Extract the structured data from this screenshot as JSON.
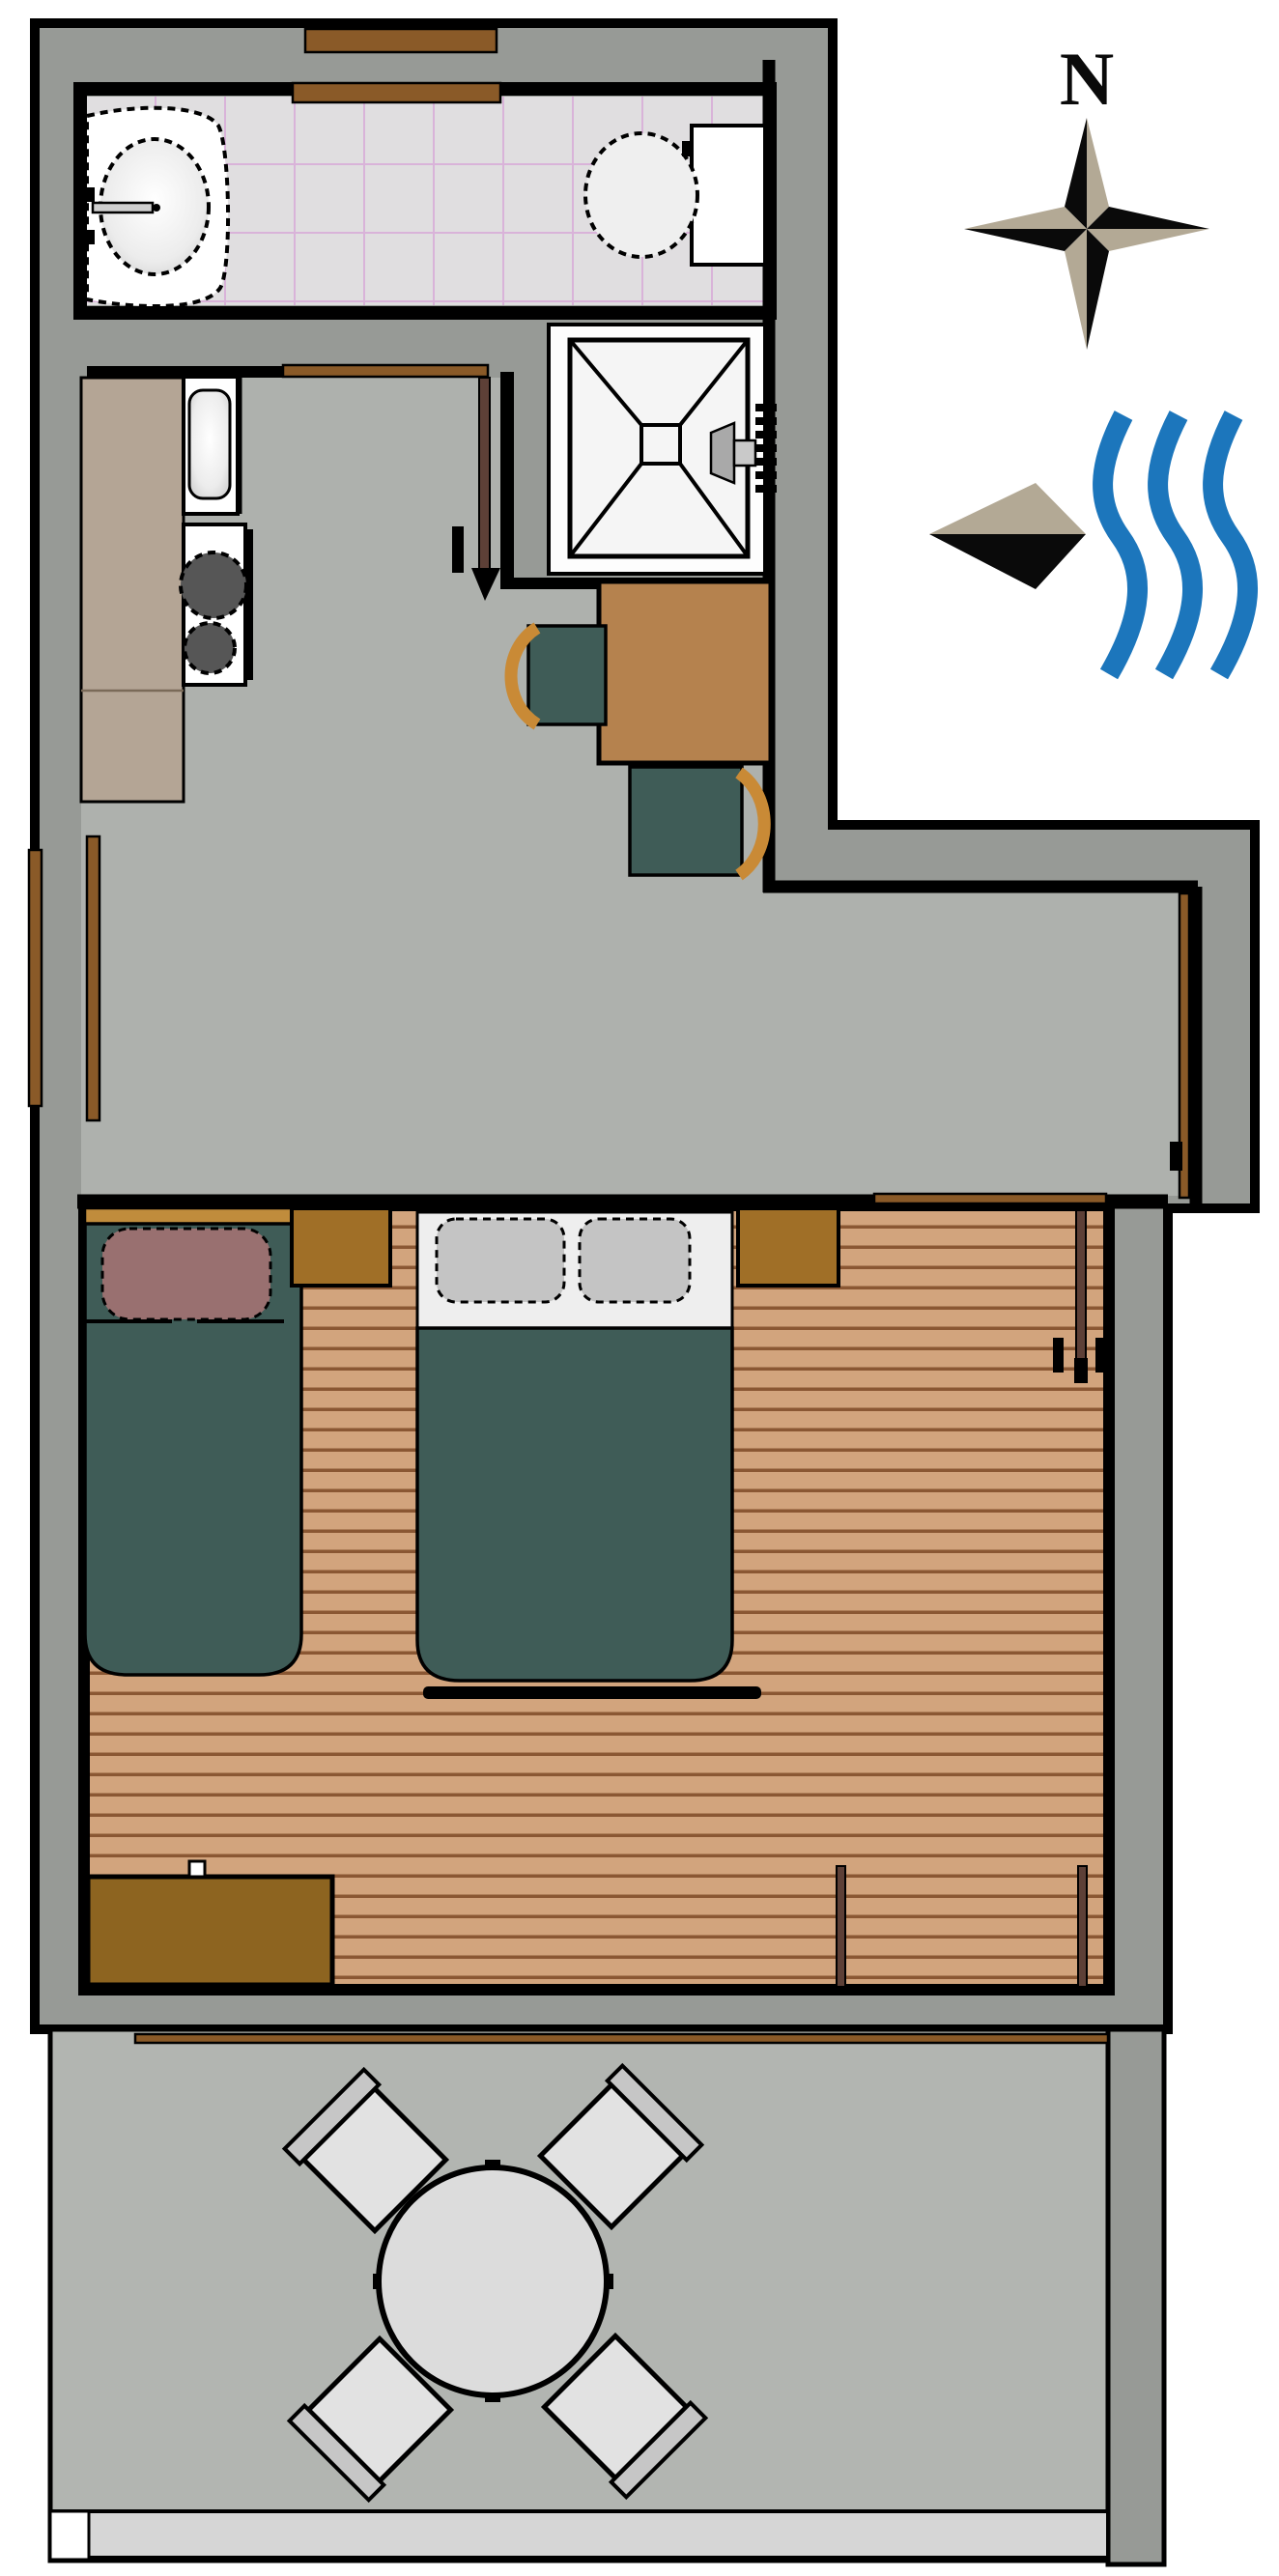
{
  "compass": {
    "label": "N",
    "icon": "compass-rose-icon"
  },
  "water_marker": {
    "waves_icon": "water-waves-icon",
    "arrow_icon": "flow-direction-arrow-icon"
  },
  "palette": {
    "wall": "#979a96",
    "floor": "#aeb1ad",
    "patio": "#b2b5b1",
    "patio-step": "#d6d6d6",
    "tile": "#e0dee0",
    "tile-line": "#d9b3d9",
    "wood": "#d2a47d",
    "plank": "#8a5733",
    "counter": "#b4a595",
    "teal": "#3f5c57",
    "table": "#b5824e",
    "nightstand": "#a06f27",
    "dresser": "#8d6420",
    "headboard": "#c08c3c",
    "frame": "#8a5a28",
    "doorleaf": "#5d4037",
    "chairwood": "#c98a36",
    "mauve": "#997070",
    "sheet": "#eeeeee",
    "pillow": "#c4c4c4",
    "fixture": "#ffffff",
    "burner": "#565656",
    "patio-furn": "#e2e2e2",
    "patio-back": "#c6c6c6",
    "compass-tan": "#b3a995",
    "wave": "#1c76bc"
  },
  "fixtures": [
    "bathroom-sink",
    "toilet",
    "shower",
    "kitchen-sink",
    "stove",
    "kitchen-counter",
    "dining-table",
    "dining-chair",
    "dining-chair",
    "single-bed",
    "double-bed",
    "nightstand",
    "nightstand",
    "dresser",
    "patio-table",
    "patio-chair",
    "patio-chair",
    "patio-chair",
    "patio-chair",
    "window",
    "door"
  ]
}
